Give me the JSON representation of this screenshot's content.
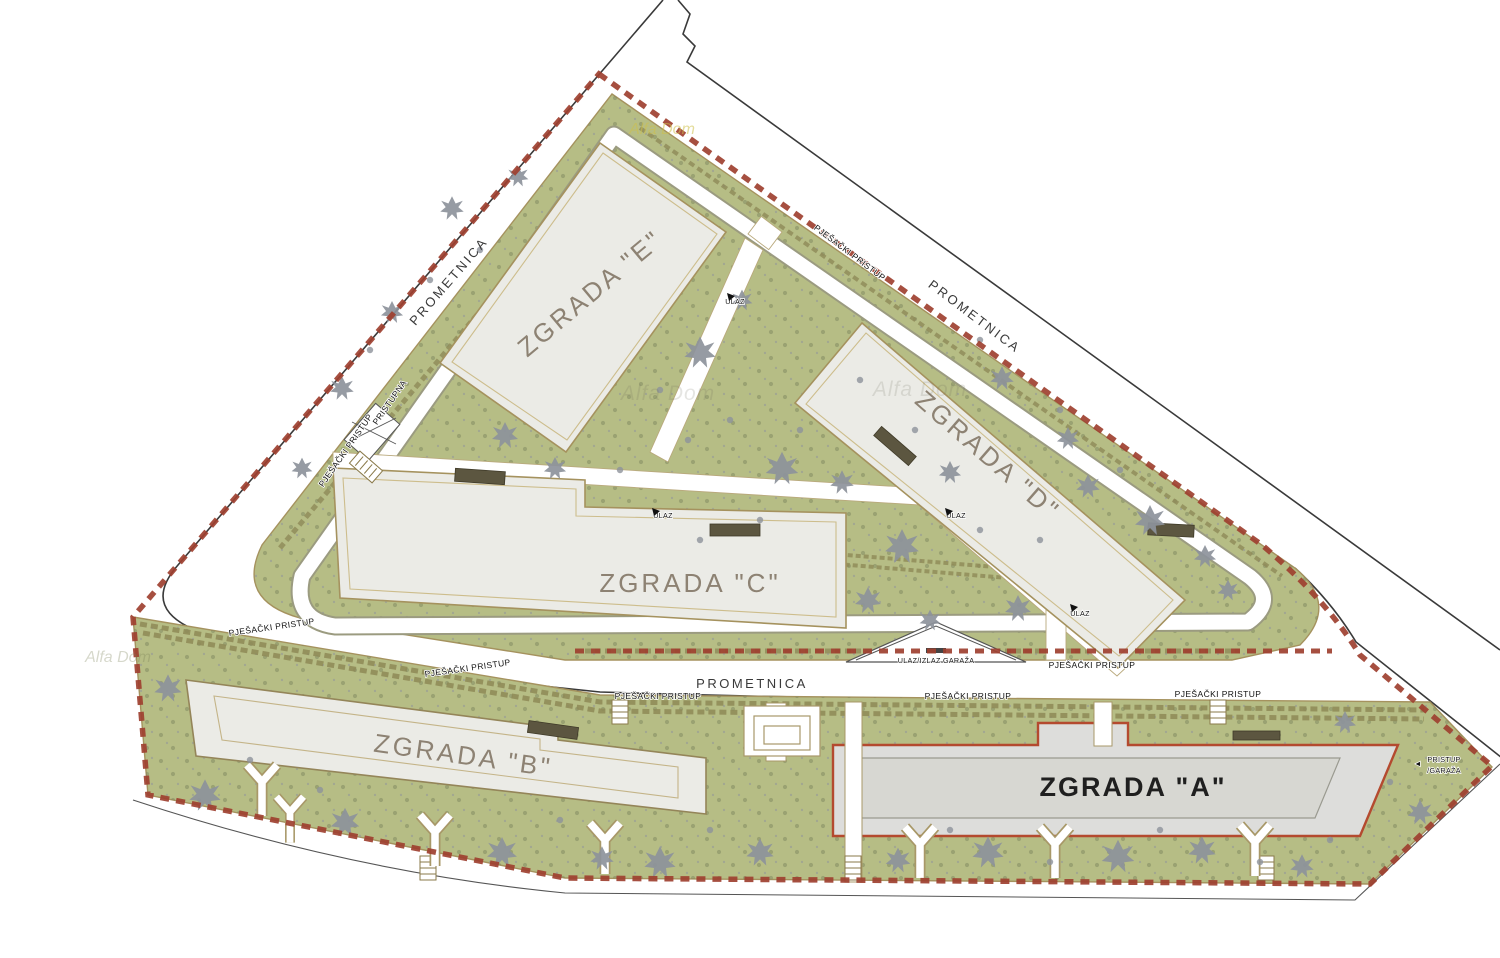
{
  "site_plan": {
    "buildings": {
      "a": "ZGRADA \"A\"",
      "b": "ZGRADA \"B\"",
      "c": "ZGRADA \"C\"",
      "d": "ZGRADA \"D\"",
      "e": "ZGRADA \"E\""
    },
    "roads": {
      "name": "PROMETNICA"
    },
    "annotations": {
      "pedestrian_access": "PJEŠAČKI PRISTUP",
      "entrance": "ULAZ",
      "access_road": "PRISTUPNA",
      "garage_ramp": "ULAZ/IZLAZ GARAŽA",
      "garage_access_line1": "PRISTUP",
      "garage_access_line2": "/GARAŽA",
      "garage_access_arrow": "◄"
    },
    "watermark": "Alfa Dom",
    "colors": {
      "site_boundary_dash": "#9e4030",
      "greenery": "#b6bd85",
      "building_fill": "#ebebe6",
      "building_outline": "#a5925e",
      "highlighted_building_outline": "#b44a2f",
      "highlighted_building_fill": "#d7d7d2",
      "tree": "#8d929b",
      "building_label_text": "#8d8273",
      "road_line": "#3a3a3a"
    }
  }
}
